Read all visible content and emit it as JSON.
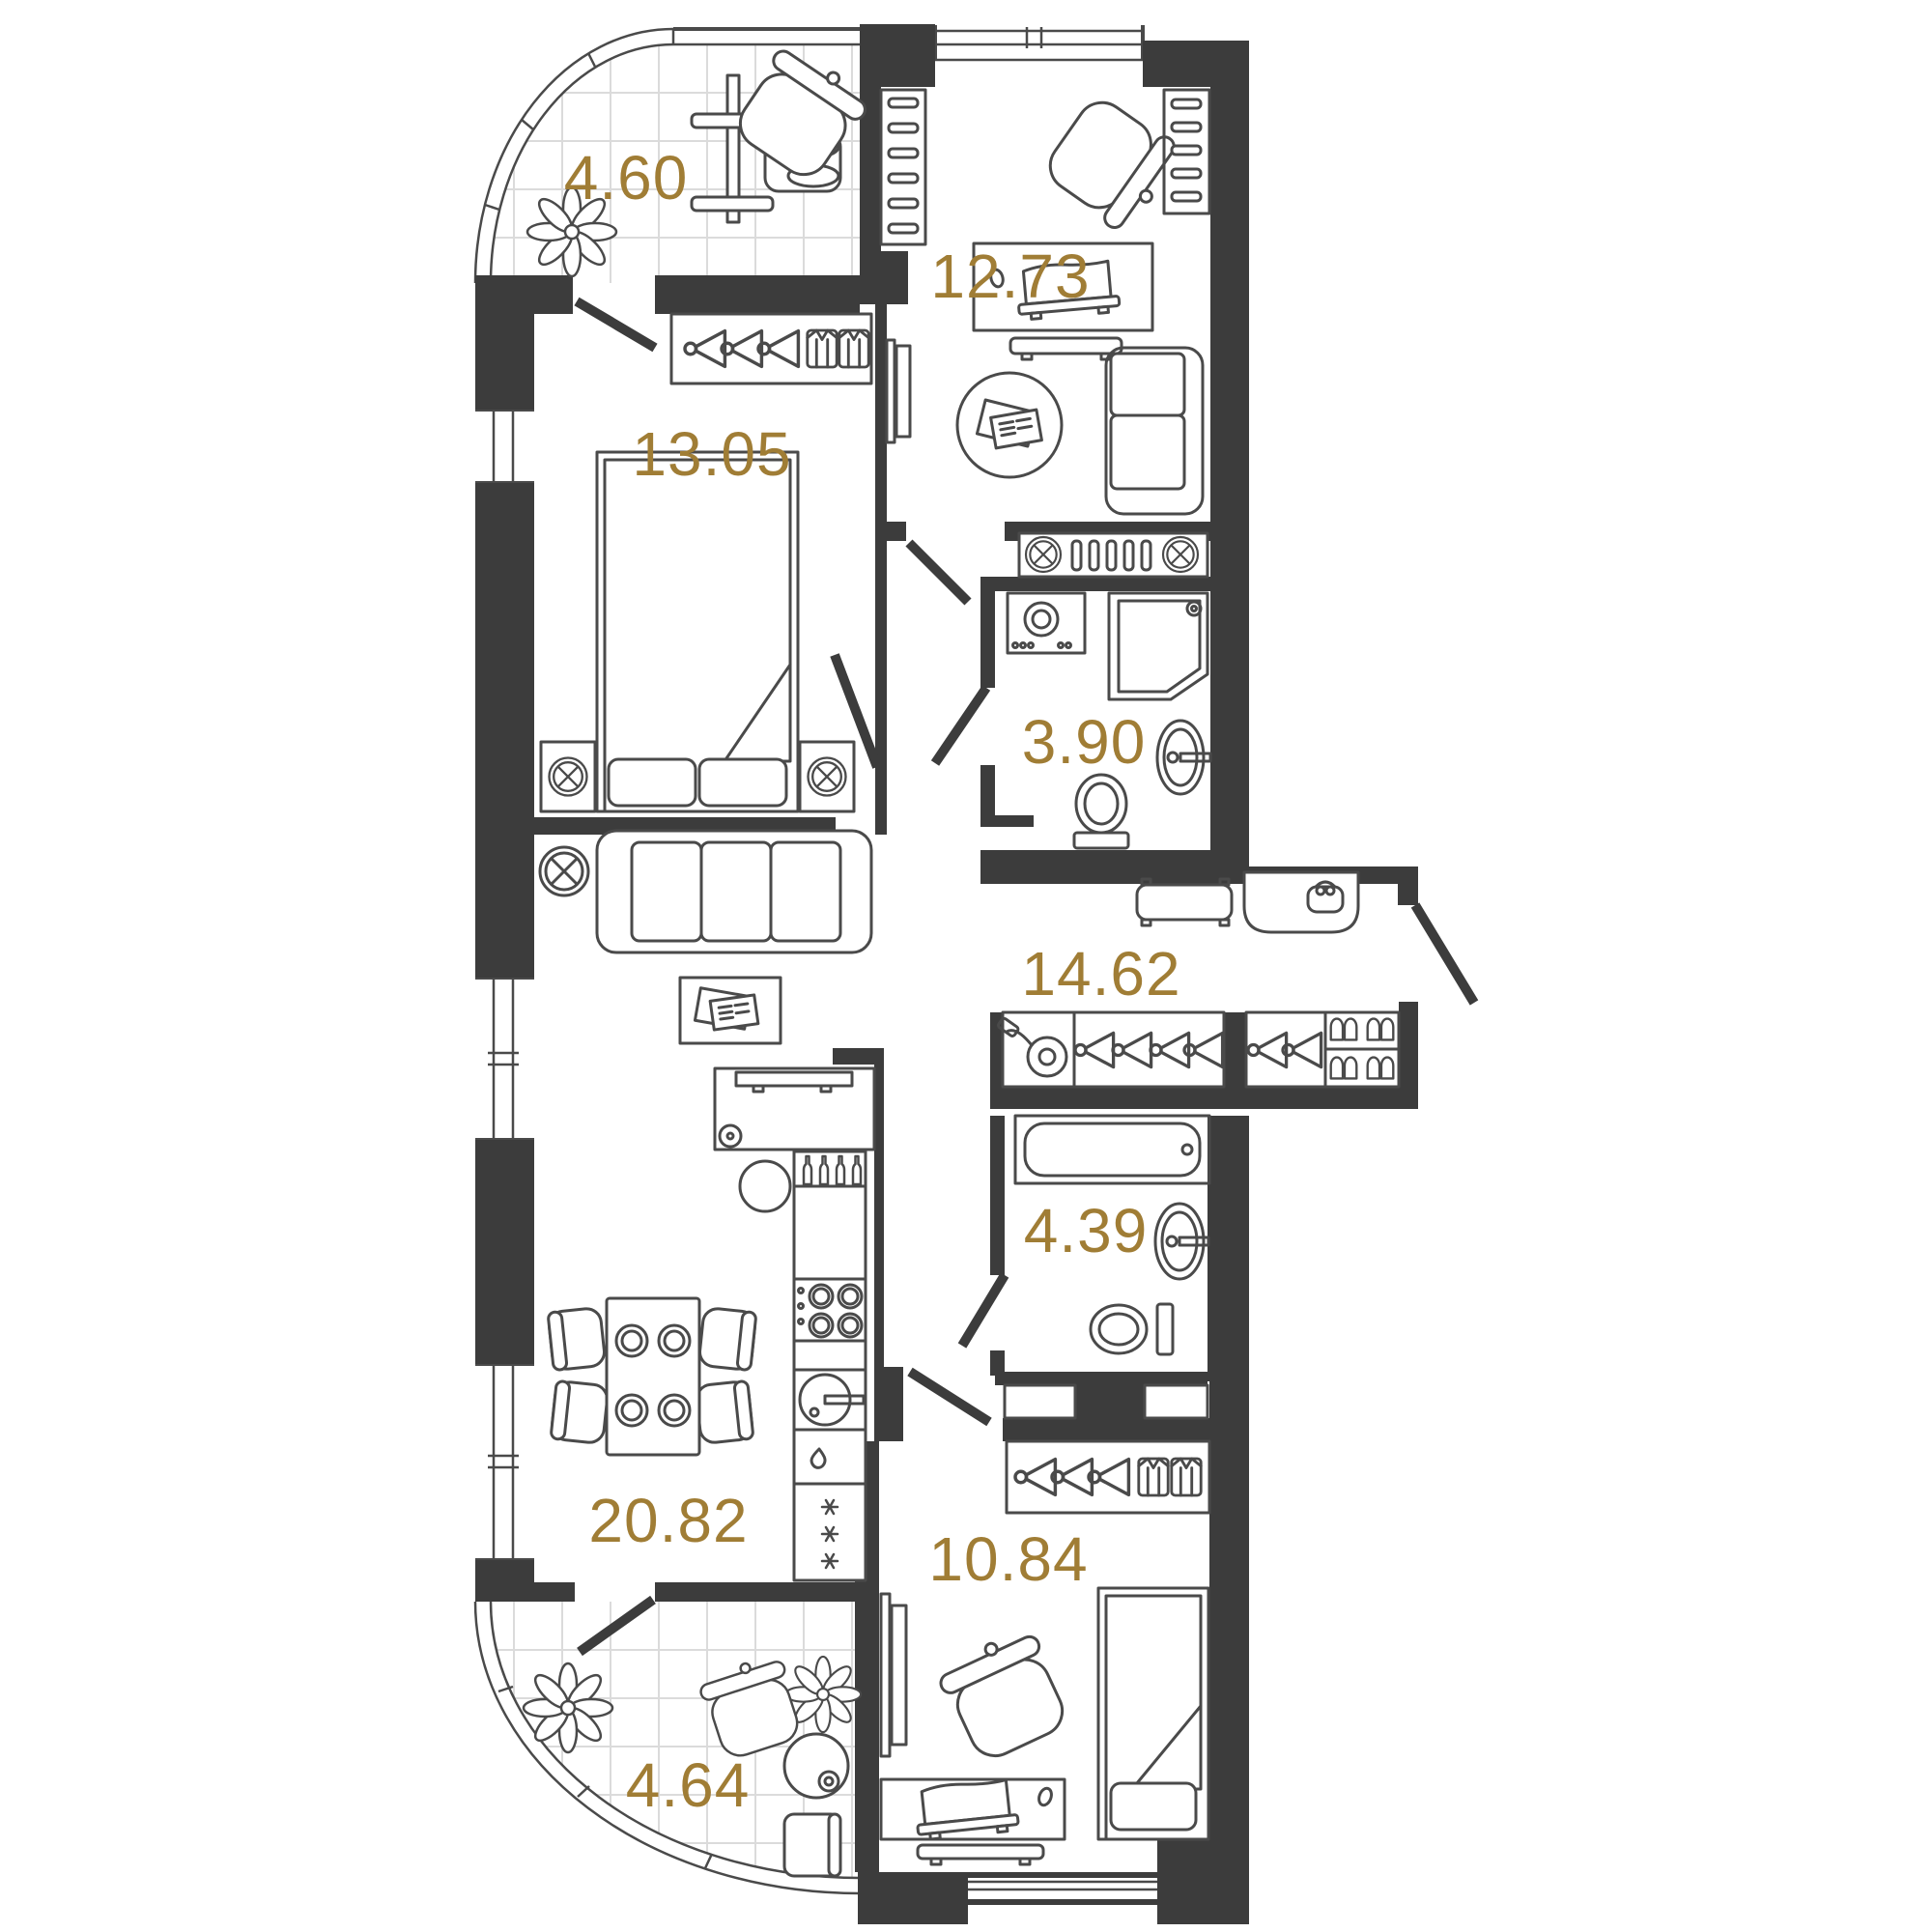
{
  "plan": {
    "type": "apartment-floor-plan",
    "rooms": {
      "balcony_top": {
        "label": "4.60"
      },
      "room_top": {
        "label": "12.73"
      },
      "bedroom_main": {
        "label": "13.05"
      },
      "bathroom_shower": {
        "label": "3.90"
      },
      "hallway": {
        "label": "14.62"
      },
      "bathroom_bath": {
        "label": "4.39"
      },
      "kitchen_living": {
        "label": "20.82"
      },
      "bedroom_second": {
        "label": "10.84"
      },
      "balcony_bottom": {
        "label": "4.64"
      }
    },
    "colors": {
      "wall": "#3C3C3C",
      "furniture_line": "#4A4A4A",
      "area_label": "#A07D35",
      "tile_grid": "#DBDBDB",
      "background": "#FFFFFF"
    },
    "icons": [
      "plant-icon",
      "exercise-machine-icon",
      "tub-chair-icon",
      "hanger-icon",
      "shirt-icon",
      "double-bed-icon",
      "single-bed-icon",
      "ceiling-lamp-icon",
      "sofa-icon",
      "coffee-table-icon",
      "tv-icon",
      "desk-icon",
      "laptop-icon",
      "mouse-icon",
      "washing-machine-icon",
      "shower-icon",
      "sink-icon",
      "toilet-icon",
      "bathtub-icon",
      "bench-icon",
      "console-icon",
      "bag-icon",
      "vacuum-icon",
      "shoe-rack-icon",
      "dining-table-icon",
      "chair-icon",
      "cooktop-icon",
      "kitchen-sink-icon",
      "fridge-icon",
      "round-table-icon",
      "bottle-icon"
    ]
  }
}
